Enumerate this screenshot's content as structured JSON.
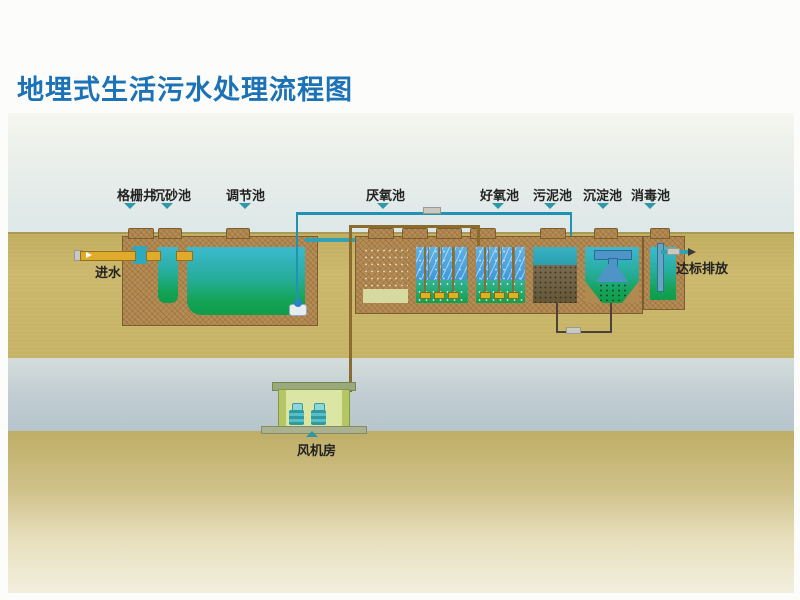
{
  "title": "地埋式生活污水处理流程图",
  "stages": [
    {
      "label": "格栅井"
    },
    {
      "label": "沉砂池"
    },
    {
      "label": "调节池"
    },
    {
      "label": "厌氧池"
    },
    {
      "label": "好氧池"
    },
    {
      "label": "污泥池"
    },
    {
      "label": "沉淀池"
    },
    {
      "label": "消毒池"
    }
  ],
  "annotations": {
    "inlet": "进水",
    "outlet": "达标排放",
    "blower_room": "风机房"
  },
  "icons": {
    "stage_pointer": "triangle-down",
    "blower_pointer": "triangle-up",
    "inlet_arrow": "arrow-right",
    "outlet_arrow": "arrow-right"
  },
  "colors": {
    "title_blue": "#1c72b6",
    "pointer_teal": "#2f98a8",
    "ground_tan": "#c6b365",
    "subsoil_blue": "#bcc9d0",
    "wall_brown": "#b58c55",
    "water_teal": "#3ab6c8",
    "water_green": "#12a150",
    "media_blue": "#4aa2de",
    "sludge_brown": "#6e6148",
    "pipe_water_blue": "#2191b5",
    "pipe_air_olive": "#8a6d2e",
    "pipe_inlet_yellow": "#e0ab2b",
    "blower_house_green": "#dbe6a4"
  }
}
